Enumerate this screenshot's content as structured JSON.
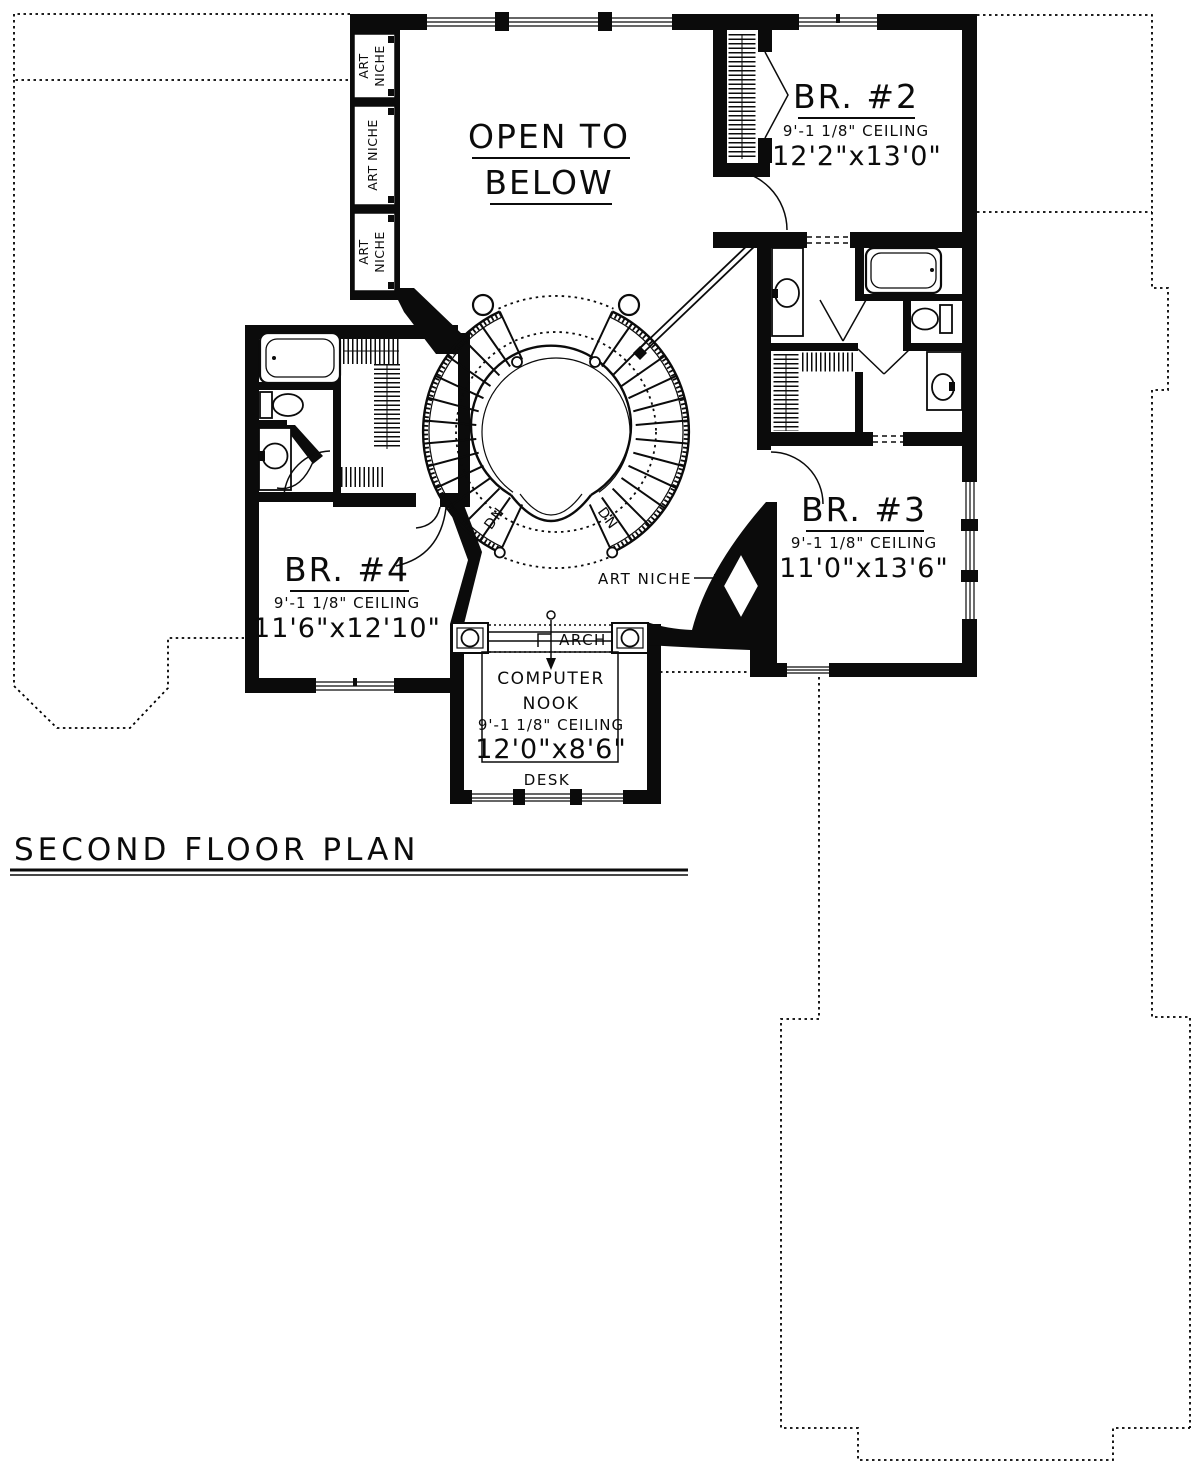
{
  "title": "SECOND FLOOR PLAN",
  "rooms": {
    "open_to_below": {
      "line1": "OPEN TO",
      "line2": "BELOW"
    },
    "br2": {
      "name": "BR. #2",
      "ceiling": "9'-1 1/8\" CEILING",
      "size": "12'2\"x13'0\""
    },
    "br3": {
      "name": "BR. #3",
      "ceiling": "9'-1 1/8\" CEILING",
      "size": "11'0\"x13'6\""
    },
    "br4": {
      "name": "BR. #4",
      "ceiling": "9'-1 1/8\" CEILING",
      "size": "11'6\"x12'10\""
    },
    "computer_nook": {
      "line1": "COMPUTER",
      "line2": "NOOK",
      "ceiling": "9'-1 1/8\" CEILING",
      "size": "12'0\"x8'6\""
    }
  },
  "labels": {
    "art": "ART",
    "niche": "NICHE",
    "art_niche": "ART NICHE",
    "arch": "ARCH",
    "desk": "DESK",
    "down": "DN"
  }
}
